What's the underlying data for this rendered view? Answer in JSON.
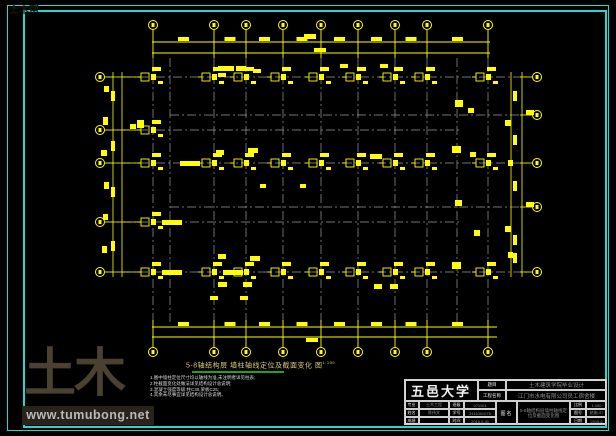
{
  "watermark": {
    "brand": "土木帮",
    "url": "www.tumubong.net"
  },
  "drawing_title": {
    "text": "5-8轴结构层 墙柱轴线定位及截面变化 图",
    "scale_note": "1:100"
  },
  "notes": {
    "lines": [
      "1.图中墙柱定位尺寸均以轴线为准,未注明者详见柱表;",
      "2.柱截面变化处做法详见结构设计总说明;",
      "3.混凝土强度等级:柱C30,梁板C25;",
      "4.其余未尽事宜详见结构设计总说明。"
    ]
  },
  "title_block": {
    "university": "五邑大学",
    "project_rows": [
      {
        "label": "题目",
        "value": "土木建筑学院毕业设计"
      },
      {
        "label": "工程名称",
        "value": "江门市水电有限公司员工宿舍楼"
      }
    ],
    "info_cells": [
      [
        {
          "label": "专业",
          "value": "土木工程"
        },
        {
          "label": "班级",
          "value": "071101"
        }
      ],
      [
        {
          "label": "姓名",
          "value": "陈伟文"
        },
        {
          "label": "学号",
          "value": "3111001078"
        }
      ],
      [
        {
          "label": "成绩",
          "value": ""
        },
        {
          "label": "时间",
          "value": "2015.5.30"
        }
      ]
    ],
    "drawing_name": {
      "label": "图名",
      "value": "5-8轴结构层墙柱轴线定位及截面变化图"
    },
    "meta": [
      {
        "label": "比例",
        "value": "1:100"
      },
      {
        "label": "图号",
        "value": "结施-07"
      },
      {
        "label": "日期",
        "value": "2015.6"
      }
    ]
  },
  "plan": {
    "colors": {
      "line": "#ffff00",
      "grid": "#9b9b9b",
      "border": "#23d9cd"
    },
    "axes_x": [
      153,
      214,
      246,
      283,
      321,
      358,
      395,
      427,
      488
    ],
    "rows": [
      {
        "y": 77,
        "x0": 105,
        "x1": 531
      },
      {
        "y": 115,
        "x0": 170,
        "x1": 531
      },
      {
        "y": 130,
        "x0": 105,
        "x1": 460
      },
      {
        "y": 163,
        "x0": 105,
        "x1": 531
      },
      {
        "y": 207,
        "x0": 170,
        "x1": 531
      },
      {
        "y": 222,
        "x0": 105,
        "x1": 460
      },
      {
        "y": 272,
        "x0": 105,
        "x1": 531
      }
    ],
    "extra_vlines": [
      170,
      457
    ],
    "top": {
      "bubble_y": 25,
      "dim1_y": 42,
      "dim2_y": 53,
      "x0": 152,
      "x1": 490,
      "dim2_blob_x": [
        320
      ],
      "over_blob": [
        310,
        36
      ]
    },
    "bottom": {
      "bubble_y": 352,
      "dim1_y": 327,
      "dim2_y": 337,
      "x0": 152,
      "x1": 497,
      "dim2_blob_x": [
        312
      ],
      "over_blob": [
        312,
        340
      ]
    },
    "left": {
      "bubble_x": 100,
      "ys": [
        77,
        130,
        163,
        222,
        272
      ],
      "dim_x": [
        113,
        122
      ],
      "vblob_y": [
        96,
        146,
        192,
        246
      ]
    },
    "right": {
      "bubble_x": 537,
      "ys": [
        77,
        115,
        163,
        207,
        272
      ],
      "dim_x": [
        511,
        522
      ],
      "vblob_y": [
        96,
        140,
        186,
        240,
        258
      ]
    },
    "column_rows": [
      {
        "y": 77,
        "xs": [
          153,
          214,
          246,
          283,
          321,
          358,
          395,
          427,
          488
        ]
      },
      {
        "y": 163,
        "xs": [
          153,
          214,
          246,
          283,
          321,
          358,
          395,
          427,
          488
        ]
      },
      {
        "y": 272,
        "xs": [
          153,
          214,
          246,
          283,
          321,
          358,
          395,
          427,
          488
        ]
      },
      {
        "y": 130,
        "xs": [
          153
        ]
      },
      {
        "y": 222,
        "xs": [
          153
        ]
      }
    ],
    "long_labels": [
      {
        "x": 153,
        "y": 222,
        "side": 1
      },
      {
        "x": 153,
        "y": 272,
        "side": 1
      },
      {
        "x": 214,
        "y": 163,
        "side": -1
      },
      {
        "x": 214,
        "y": 272,
        "side": 1
      }
    ],
    "extra_marks": [
      [
        104,
        86,
        5,
        6
      ],
      [
        103,
        117,
        5,
        8
      ],
      [
        101,
        150,
        6,
        6
      ],
      [
        104,
        182,
        5,
        7
      ],
      [
        103,
        214,
        5,
        6
      ],
      [
        102,
        246,
        5,
        7
      ],
      [
        137,
        120,
        7,
        8
      ],
      [
        130,
        124,
        6,
        5
      ],
      [
        218,
        66,
        16,
        5
      ],
      [
        236,
        66,
        10,
        5
      ],
      [
        218,
        73,
        8,
        4
      ],
      [
        253,
        69,
        8,
        4
      ],
      [
        248,
        148,
        10,
        5
      ],
      [
        216,
        150,
        8,
        5
      ],
      [
        370,
        154,
        12,
        5
      ],
      [
        250,
        256,
        10,
        5
      ],
      [
        218,
        254,
        8,
        5
      ],
      [
        455,
        100,
        8,
        7
      ],
      [
        452,
        146,
        9,
        7
      ],
      [
        468,
        108,
        6,
        5
      ],
      [
        470,
        152,
        6,
        5
      ],
      [
        474,
        230,
        6,
        6
      ],
      [
        452,
        262,
        9,
        7
      ],
      [
        455,
        200,
        7,
        6
      ],
      [
        505,
        120,
        6,
        6
      ],
      [
        508,
        160,
        5,
        6
      ],
      [
        505,
        226,
        6,
        6
      ],
      [
        508,
        252,
        5,
        6
      ],
      [
        218,
        282,
        9,
        5
      ],
      [
        243,
        282,
        9,
        5
      ],
      [
        374,
        284,
        8,
        5
      ],
      [
        390,
        284,
        8,
        5
      ],
      [
        340,
        64,
        8,
        4
      ],
      [
        380,
        64,
        8,
        4
      ],
      [
        260,
        184,
        6,
        4
      ],
      [
        300,
        184,
        6,
        4
      ],
      [
        526,
        110,
        8,
        5
      ],
      [
        526,
        202,
        8,
        5
      ],
      [
        210,
        296,
        8,
        4
      ],
      [
        240,
        296,
        8,
        4
      ]
    ]
  }
}
